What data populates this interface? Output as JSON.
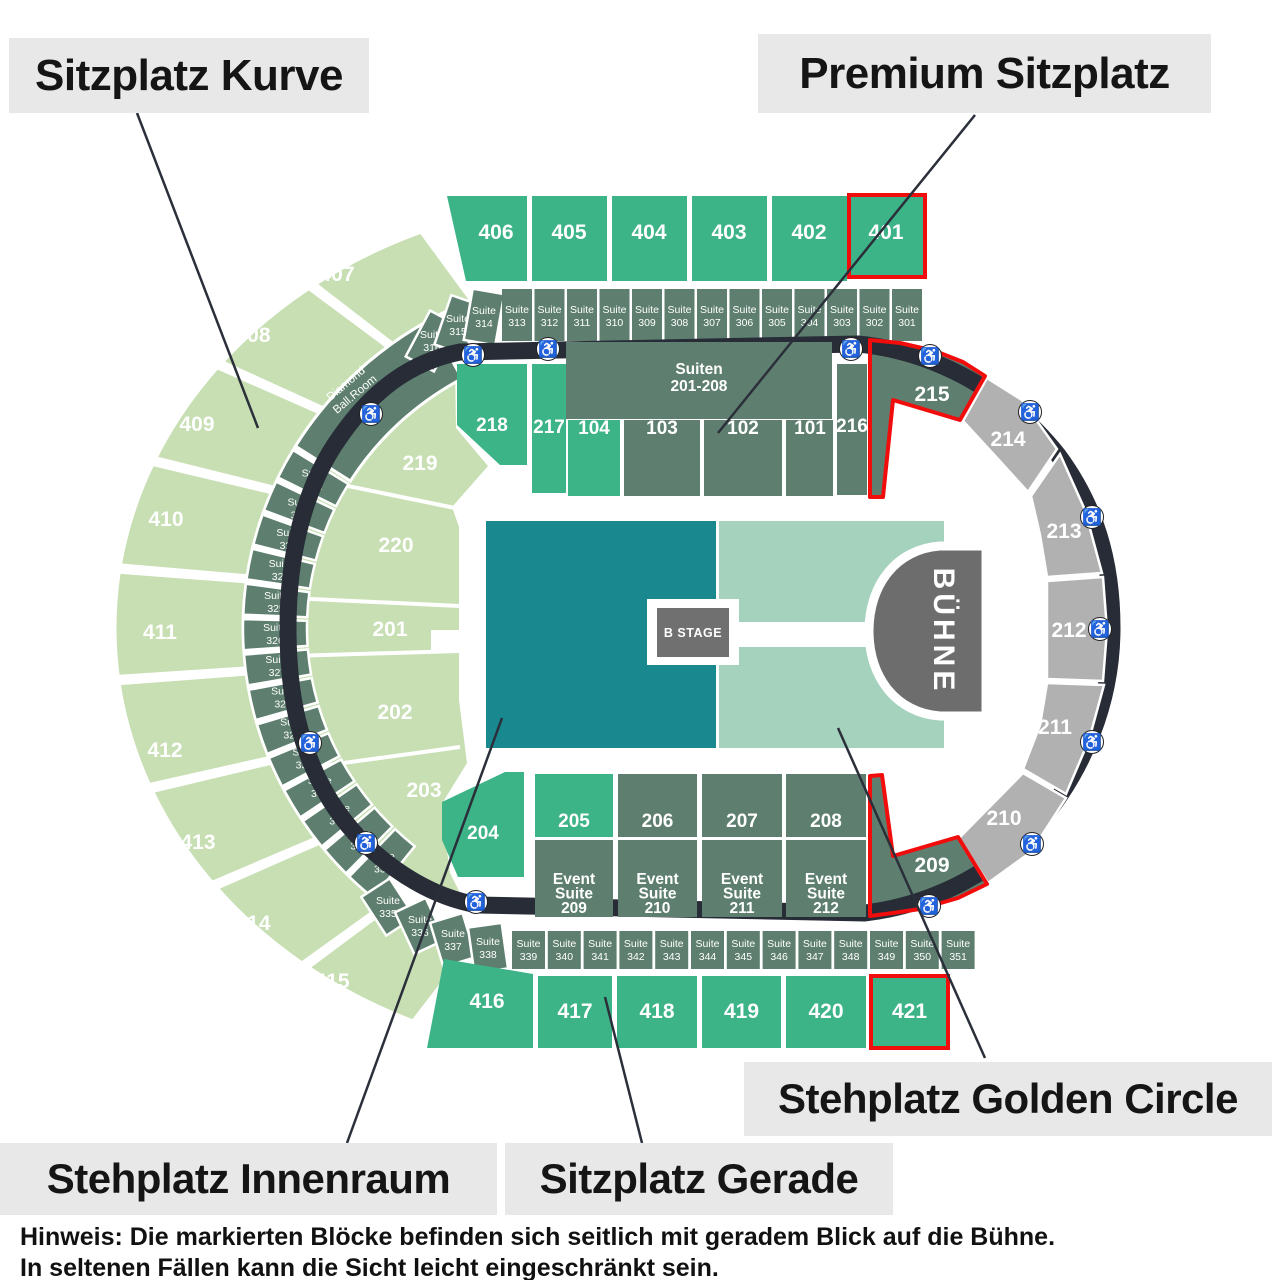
{
  "legend": {
    "sitzplatz_kurve": "Sitzplatz Kurve",
    "premium_sitzplatz": "Premium Sitzplatz",
    "stehplatz_golden_circle": "Stehplatz Golden Circle",
    "stehplatz_innenraum": "Stehplatz Innenraum",
    "sitzplatz_gerade": "Sitzplatz Gerade"
  },
  "note": {
    "line1": "Hinweis: Die markierten Blöcke befinden sich seitlich mit  geradem Blick auf die Bühne.",
    "line2": "In seltenen Fällen kann die Sicht leicht eingeschränkt sein."
  },
  "stage": {
    "label": "BÜHNE"
  },
  "b_stage": {
    "label": "B STAGE"
  },
  "suiten_block": {
    "line1": "Suiten",
    "line2": "201-208"
  },
  "diamond_ballroom": {
    "line1": "Diamond",
    "line2": "Ball.Room"
  },
  "sections": {
    "top_row": [
      "406",
      "405",
      "404",
      "403",
      "402",
      "401"
    ],
    "bottom_row": [
      "416",
      "417",
      "418",
      "419",
      "420",
      "421"
    ],
    "outer_curve": [
      "407",
      "408",
      "409",
      "410",
      "411",
      "412",
      "413",
      "414",
      "415"
    ],
    "inner_curve": [
      "219",
      "220",
      "201",
      "202",
      "203"
    ],
    "upper_mid": [
      "218",
      "217",
      "104",
      "103",
      "102",
      "101",
      "216",
      "215"
    ],
    "lower_mid": [
      "204",
      "205",
      "206",
      "207",
      "208",
      "209"
    ],
    "event_suites": [
      [
        "Event",
        "Suite",
        "209"
      ],
      [
        "Event",
        "Suite",
        "210"
      ],
      [
        "Event",
        "Suite",
        "211"
      ],
      [
        "Event",
        "Suite",
        "212"
      ]
    ],
    "right_arc": [
      "214",
      "213",
      "212",
      "211",
      "210"
    ]
  },
  "suites": {
    "top_slanted": [
      "Suite 316",
      "Suite 315",
      "Suite 314"
    ],
    "top": [
      "Suite 313",
      "Suite 312",
      "Suite 311",
      "Suite 310",
      "Suite 309",
      "Suite 308",
      "Suite 307",
      "Suite 306",
      "Suite 305",
      "Suite 304",
      "Suite 303",
      "Suite 302",
      "Suite 301"
    ],
    "left": [
      "Suite 321",
      "Suite 322",
      "Suite 323",
      "Suite 324",
      "Suite 325",
      "Suite 326",
      "Suite 327",
      "Suite 328",
      "Suite 329",
      "Suite 330",
      "Suite 331",
      "Suite 332",
      "Suite 333",
      "Suite 334"
    ],
    "left_lower_slanted": [
      "Suite 335",
      "Suite 336",
      "Suite 337",
      "Suite 338"
    ],
    "bottom": [
      "Suite 339",
      "Suite 340",
      "Suite 341",
      "Suite 342",
      "Suite 343",
      "Suite 344",
      "Suite 345",
      "Suite 346",
      "Suite 347",
      "Suite 348",
      "Suite 349",
      "Suite 350",
      "Suite 351"
    ]
  },
  "highlighted_sections": [
    "401",
    "215",
    "209",
    "421"
  ],
  "icons": {
    "wheelchair": "♿"
  },
  "colors": {
    "bright_green": "#3cb488",
    "dark_sage": "#5e7f6f",
    "light_green": "#c7dfb3",
    "floor_teal": "#19898f",
    "golden_circle": "#a5d2bc",
    "gray_section": "#b1b1b1",
    "band": "#272c37",
    "stage_gray": "#6d6d6d",
    "red": "#f20d0d",
    "label_bg": "#e8e8e8",
    "line": "#2a2f3a",
    "white": "#ffffff"
  }
}
